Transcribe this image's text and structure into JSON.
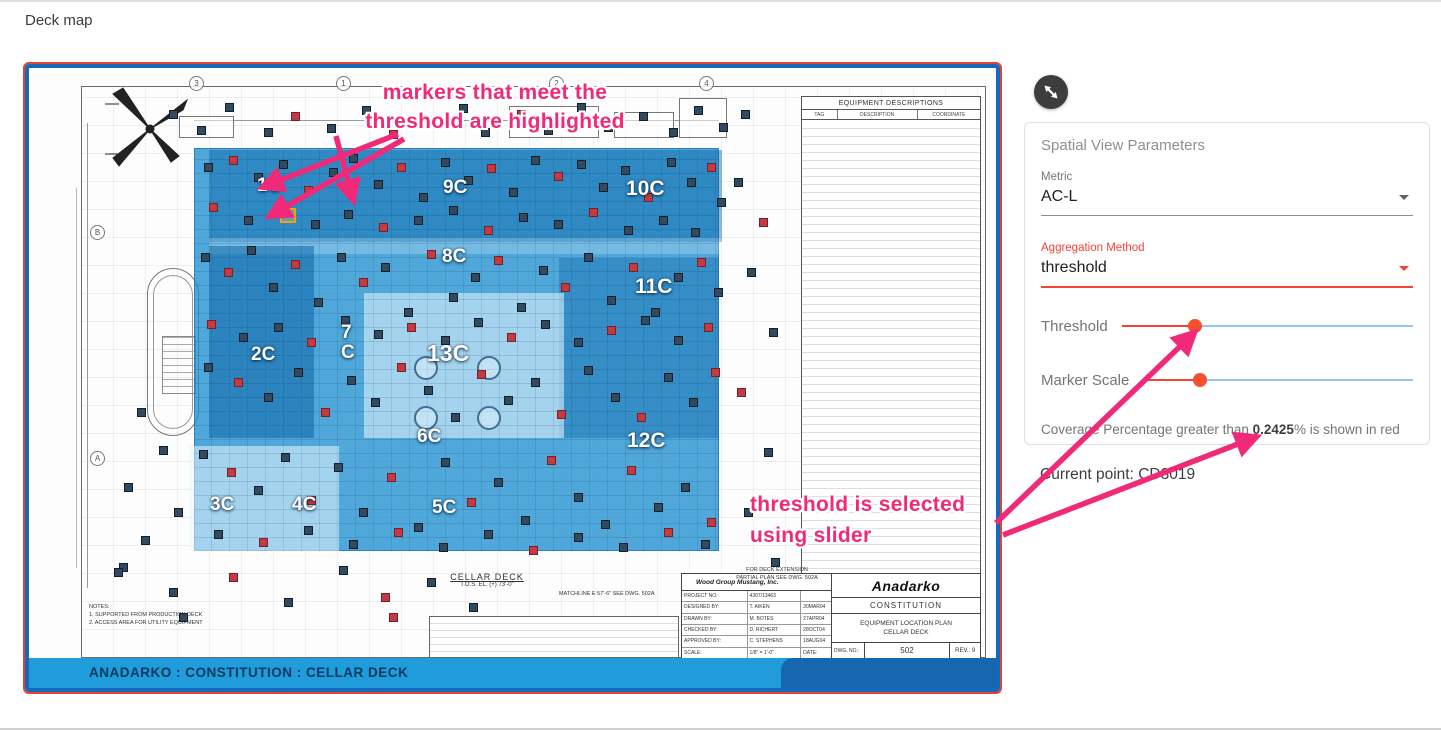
{
  "page": {
    "title": "Deck map"
  },
  "panel": {
    "expand_icon": "resize-diagonal",
    "card_title": "Spatial View Parameters",
    "metric": {
      "label": "Metric",
      "value": "AC-L"
    },
    "aggregation": {
      "label": "Aggregation Method",
      "value": "threshold"
    },
    "threshold": {
      "label": "Threshold",
      "percent": 25
    },
    "marker_scale": {
      "label": "Marker Scale",
      "percent": 21
    },
    "coverage": {
      "prefix": "Coverage Percentage greater than ",
      "value": "0.2425",
      "suffix": "% is shown in red"
    },
    "current_point": "Current point: CD3019"
  },
  "annotations": {
    "color": "#f02a78",
    "note1_line1": "markers that meet the",
    "note1_line2": "threshold are highlighted",
    "note2_line1": "threshold is selected",
    "note2_line2": "using slider",
    "arrows": [
      [
        398,
        132,
        263,
        185
      ],
      [
        404,
        137,
        270,
        214
      ],
      [
        336,
        134,
        353,
        198
      ],
      [
        996,
        521,
        1194,
        331
      ],
      [
        1003,
        533,
        1256,
        435
      ]
    ]
  },
  "map": {
    "footer": "ANADARKO : CONSTITUTION : CELLAR DECK",
    "cellar_deck_label": "CELLAR DECK",
    "cellar_deck_sub": "T.O.S. EL. (+) 73'-0\"",
    "extension_note": "FOR DECK EXTENSION\nPARTIAL PLAN SEE DWG. 502A",
    "matchline_note": "MATCHLINE E 57'-6\" SEE DWG. 502A",
    "notes": "NOTES:\n1. SUPPORTED FROM PRODUCTION DECK\n2. ACCESS AREA FOR UTILITY EQUIPMENT",
    "grid_bubbles": [
      {
        "text": "3",
        "x": 160,
        "y": 8
      },
      {
        "text": "1",
        "x": 307,
        "y": 8
      },
      {
        "text": "2",
        "x": 520,
        "y": 8
      },
      {
        "text": "4",
        "x": 670,
        "y": 8
      },
      {
        "text": "B",
        "x": 61,
        "y": 157
      },
      {
        "text": "A",
        "x": 61,
        "y": 383
      }
    ],
    "deck_labels": [
      {
        "text": "1C",
        "x": 228,
        "y": 108,
        "cls": ""
      },
      {
        "text": "9C",
        "x": 414,
        "y": 110,
        "cls": ""
      },
      {
        "text": "10C",
        "x": 597,
        "y": 111,
        "cls": "dl-med"
      },
      {
        "text": "8C",
        "x": 413,
        "y": 179,
        "cls": ""
      },
      {
        "text": "11C",
        "x": 606,
        "y": 209,
        "cls": "dl-med"
      },
      {
        "text": "7\nC",
        "x": 312,
        "y": 255,
        "cls": ""
      },
      {
        "text": "2C",
        "x": 222,
        "y": 277,
        "cls": ""
      },
      {
        "text": "13C",
        "x": 398,
        "y": 275,
        "cls": "dl-big"
      },
      {
        "text": "6C",
        "x": 388,
        "y": 359,
        "cls": ""
      },
      {
        "text": "12C",
        "x": 598,
        "y": 363,
        "cls": "dl-med"
      },
      {
        "text": "3C",
        "x": 181,
        "y": 427,
        "cls": ""
      },
      {
        "text": "4C",
        "x": 263,
        "y": 427,
        "cls": ""
      },
      {
        "text": "5C",
        "x": 403,
        "y": 430,
        "cls": ""
      }
    ],
    "selected_marker": {
      "x": 251,
      "y": 140
    },
    "equipment_table": {
      "title": "EQUIPMENT DESCRIPTIONS",
      "columns": [
        "TAG",
        "DESCRIPTION",
        "COORDINATE"
      ]
    },
    "title_block": {
      "company": "Wood Group Mustang, Inc.",
      "rows": [
        [
          "PROJECT NO.:",
          "4307/13463",
          ""
        ],
        [
          "DESIGNED BY:",
          "T. AIKEN",
          "30MAR04"
        ],
        [
          "DRAWN BY:",
          "M. BOTES",
          "27APR04"
        ],
        [
          "CHECKED BY:",
          "D. RICHERT",
          "28OCT04"
        ],
        [
          "APPROVED BY:",
          "C. STEPHENS",
          "18AUG04"
        ],
        [
          "SCALE:",
          "1/8\" = 1'-0\"",
          "DATE:"
        ]
      ],
      "client_logo": "Anadarko",
      "client_sub": "CONSTITUTION",
      "plan_line1": "EQUIPMENT LOCATION PLAN",
      "plan_line2": "CELLAR DECK",
      "dwg_label": "DWG. NO.:",
      "dwg_no": "502",
      "rev": "REV.:  9"
    },
    "markers": [
      [
        140,
        42,
        0
      ],
      [
        168,
        58,
        0
      ],
      [
        196,
        35,
        0
      ],
      [
        235,
        60,
        0
      ],
      [
        262,
        44,
        1
      ],
      [
        298,
        56,
        0
      ],
      [
        333,
        38,
        0
      ],
      [
        360,
        62,
        1
      ],
      [
        395,
        48,
        0
      ],
      [
        430,
        36,
        0
      ],
      [
        452,
        60,
        0
      ],
      [
        488,
        42,
        1
      ],
      [
        515,
        58,
        0
      ],
      [
        548,
        35,
        0
      ],
      [
        575,
        55,
        0
      ],
      [
        610,
        44,
        0
      ],
      [
        640,
        60,
        0
      ],
      [
        665,
        38,
        0
      ],
      [
        690,
        55,
        0
      ],
      [
        712,
        42,
        0
      ],
      [
        175,
        95,
        0
      ],
      [
        200,
        88,
        1
      ],
      [
        225,
        105,
        0
      ],
      [
        250,
        92,
        0
      ],
      [
        275,
        118,
        1
      ],
      [
        300,
        100,
        0
      ],
      [
        320,
        86,
        0
      ],
      [
        345,
        112,
        0
      ],
      [
        368,
        95,
        1
      ],
      [
        390,
        125,
        0
      ],
      [
        412,
        90,
        0
      ],
      [
        435,
        108,
        0
      ],
      [
        458,
        96,
        1
      ],
      [
        480,
        120,
        0
      ],
      [
        502,
        88,
        0
      ],
      [
        525,
        104,
        1
      ],
      [
        548,
        92,
        0
      ],
      [
        570,
        115,
        0
      ],
      [
        592,
        98,
        0
      ],
      [
        615,
        125,
        1
      ],
      [
        638,
        90,
        0
      ],
      [
        658,
        110,
        0
      ],
      [
        678,
        95,
        1
      ],
      [
        688,
        130,
        0
      ],
      [
        180,
        135,
        1
      ],
      [
        215,
        148,
        0
      ],
      [
        248,
        140,
        1
      ],
      [
        282,
        152,
        0
      ],
      [
        315,
        142,
        0
      ],
      [
        350,
        155,
        1
      ],
      [
        385,
        148,
        0
      ],
      [
        420,
        138,
        0
      ],
      [
        455,
        158,
        1
      ],
      [
        490,
        145,
        0
      ],
      [
        525,
        152,
        0
      ],
      [
        560,
        140,
        1
      ],
      [
        595,
        158,
        0
      ],
      [
        630,
        148,
        0
      ],
      [
        662,
        160,
        0
      ],
      [
        172,
        185,
        0
      ],
      [
        195,
        200,
        1
      ],
      [
        218,
        178,
        0
      ],
      [
        240,
        215,
        0
      ],
      [
        262,
        192,
        1
      ],
      [
        285,
        230,
        0
      ],
      [
        308,
        185,
        0
      ],
      [
        330,
        210,
        1
      ],
      [
        352,
        195,
        0
      ],
      [
        375,
        240,
        0
      ],
      [
        398,
        182,
        1
      ],
      [
        420,
        225,
        0
      ],
      [
        442,
        205,
        0
      ],
      [
        465,
        188,
        1
      ],
      [
        488,
        235,
        0
      ],
      [
        510,
        198,
        0
      ],
      [
        532,
        215,
        1
      ],
      [
        555,
        185,
        0
      ],
      [
        578,
        228,
        0
      ],
      [
        600,
        195,
        1
      ],
      [
        622,
        240,
        0
      ],
      [
        645,
        205,
        0
      ],
      [
        668,
        190,
        1
      ],
      [
        685,
        220,
        0
      ],
      [
        178,
        252,
        1
      ],
      [
        210,
        265,
        0
      ],
      [
        245,
        255,
        0
      ],
      [
        278,
        270,
        1
      ],
      [
        312,
        248,
        0
      ],
      [
        345,
        262,
        0
      ],
      [
        378,
        255,
        1
      ],
      [
        412,
        268,
        0
      ],
      [
        445,
        250,
        0
      ],
      [
        478,
        265,
        1
      ],
      [
        512,
        252,
        0
      ],
      [
        545,
        270,
        0
      ],
      [
        578,
        258,
        1
      ],
      [
        612,
        248,
        0
      ],
      [
        645,
        268,
        0
      ],
      [
        675,
        255,
        1
      ],
      [
        175,
        295,
        0
      ],
      [
        205,
        310,
        1
      ],
      [
        235,
        325,
        0
      ],
      [
        265,
        300,
        0
      ],
      [
        292,
        340,
        1
      ],
      [
        318,
        308,
        0
      ],
      [
        342,
        330,
        0
      ],
      [
        368,
        295,
        1
      ],
      [
        395,
        318,
        0
      ],
      [
        422,
        345,
        0
      ],
      [
        448,
        302,
        1
      ],
      [
        475,
        328,
        0
      ],
      [
        502,
        310,
        0
      ],
      [
        528,
        342,
        1
      ],
      [
        555,
        298,
        0
      ],
      [
        582,
        325,
        0
      ],
      [
        608,
        345,
        1
      ],
      [
        635,
        305,
        0
      ],
      [
        660,
        330,
        0
      ],
      [
        682,
        300,
        1
      ],
      [
        170,
        382,
        0
      ],
      [
        198,
        400,
        1
      ],
      [
        225,
        418,
        0
      ],
      [
        252,
        385,
        0
      ],
      [
        278,
        428,
        1
      ],
      [
        305,
        395,
        0
      ],
      [
        330,
        440,
        0
      ],
      [
        358,
        405,
        1
      ],
      [
        385,
        455,
        0
      ],
      [
        412,
        390,
        0
      ],
      [
        438,
        430,
        1
      ],
      [
        465,
        410,
        0
      ],
      [
        492,
        448,
        0
      ],
      [
        518,
        388,
        1
      ],
      [
        545,
        425,
        0
      ],
      [
        572,
        452,
        0
      ],
      [
        598,
        398,
        1
      ],
      [
        625,
        435,
        0
      ],
      [
        652,
        415,
        0
      ],
      [
        678,
        450,
        1
      ],
      [
        185,
        462,
        0
      ],
      [
        230,
        470,
        1
      ],
      [
        275,
        458,
        0
      ],
      [
        320,
        472,
        0
      ],
      [
        365,
        460,
        1
      ],
      [
        410,
        475,
        0
      ],
      [
        455,
        462,
        0
      ],
      [
        500,
        478,
        1
      ],
      [
        545,
        465,
        0
      ],
      [
        590,
        475,
        0
      ],
      [
        635,
        460,
        1
      ],
      [
        672,
        472,
        0
      ],
      [
        90,
        495,
        0
      ],
      [
        140,
        520,
        0
      ],
      [
        200,
        505,
        1
      ],
      [
        255,
        530,
        0
      ],
      [
        310,
        498,
        0
      ],
      [
        352,
        525,
        1
      ],
      [
        398,
        510,
        0
      ],
      [
        440,
        535,
        0
      ],
      [
        150,
        545,
        0
      ],
      [
        360,
        545,
        1
      ],
      [
        108,
        340,
        0
      ],
      [
        130,
        378,
        0
      ],
      [
        95,
        415,
        0
      ],
      [
        145,
        440,
        0
      ],
      [
        112,
        468,
        0
      ],
      [
        85,
        500,
        0
      ],
      [
        705,
        110,
        0
      ],
      [
        730,
        150,
        1
      ],
      [
        718,
        200,
        0
      ],
      [
        740,
        260,
        0
      ],
      [
        708,
        320,
        1
      ],
      [
        735,
        380,
        0
      ],
      [
        715,
        440,
        0
      ],
      [
        742,
        490,
        0
      ]
    ]
  }
}
